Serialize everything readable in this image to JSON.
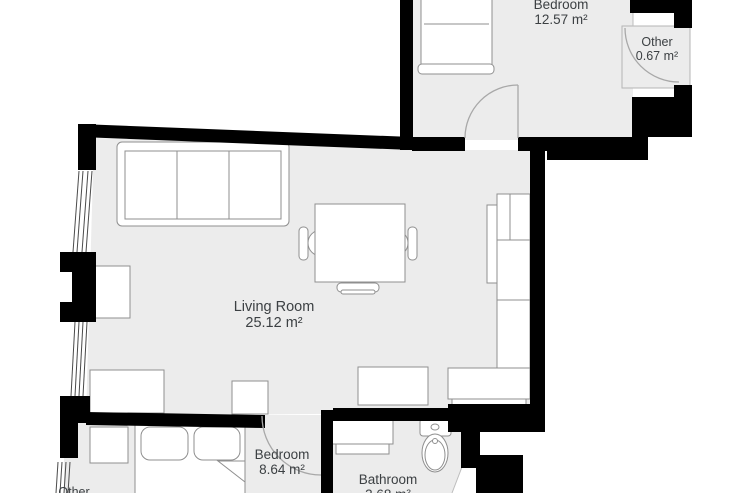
{
  "rooms": [
    {
      "id": "bedroom-top",
      "name": "Bedroom",
      "area": "12.57 m²"
    },
    {
      "id": "other-top",
      "name": "Other",
      "area": "0.67 m²"
    },
    {
      "id": "living-room",
      "name": "Living Room",
      "area": "25.12 m²"
    },
    {
      "id": "bedroom-bottom",
      "name": "Bedroom",
      "area": "8.64 m²"
    },
    {
      "id": "bathroom",
      "name": "Bathroom",
      "area": "3.68 m²"
    },
    {
      "id": "other-bottom",
      "name": "Other"
    }
  ],
  "colors": {
    "wall": "#000000",
    "floor": "#ececec",
    "furniture_stroke": "#8f8f8f",
    "label_text": "#3c4043",
    "door_stroke": "#a8a8a8",
    "background": "#ffffff"
  }
}
